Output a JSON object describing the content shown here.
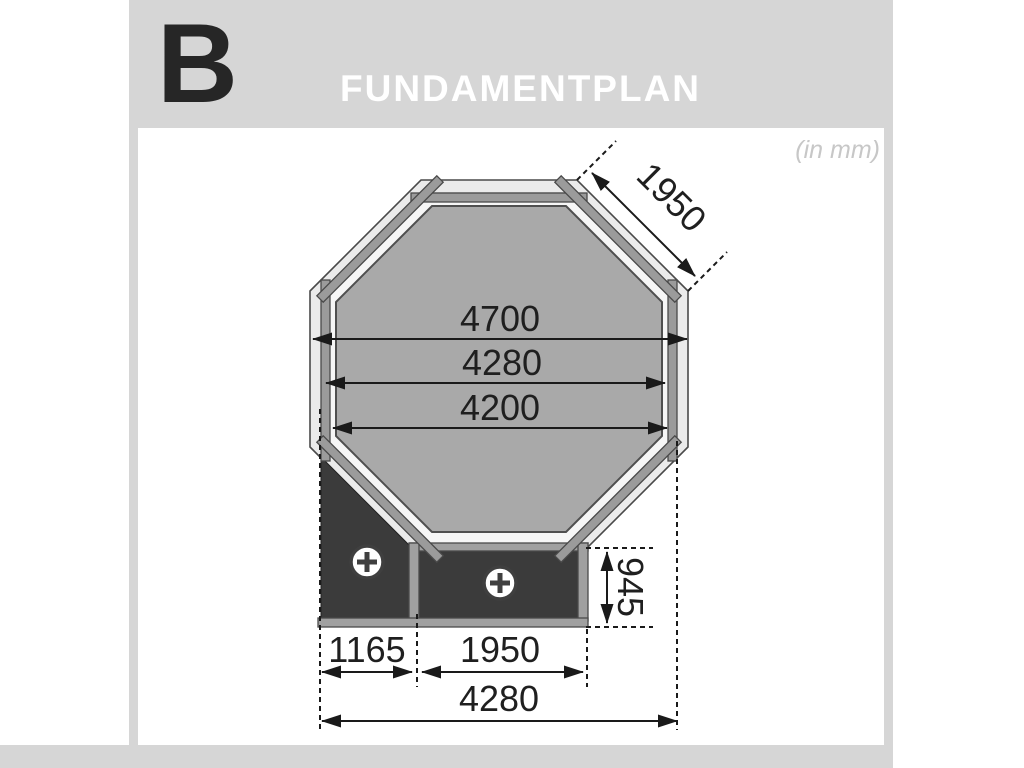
{
  "page": {
    "letter": "B",
    "title": "FUNDAMENTPLAN",
    "unit_note": "(in mm)"
  },
  "dimensions": {
    "side_length": "1950",
    "outer_width": "4700",
    "wall_width": "4280",
    "inner_width": "4200",
    "terrace_depth": "945",
    "terrace_left_width": "1165",
    "terrace_middle_width": "1950",
    "terrace_total_width": "4280"
  },
  "icons": {
    "anchor_point": "circle-plus-anchor-icon"
  },
  "colors": {
    "page_frame_gray": "#d6d6d6",
    "title_text": "#ffffff",
    "section_letter": "#262626",
    "unit_note_text": "#c7c7c7",
    "octagon_ring_fill": "#ebebeb",
    "octagon_mid_fill": "#f6f6f6",
    "octagon_inner_fill": "#a9a9a9",
    "foundation_beam_fill": "#9b9b9b",
    "terrace_slab_fill": "#3b3b3b",
    "dimension_line": "#1a1a1a"
  }
}
